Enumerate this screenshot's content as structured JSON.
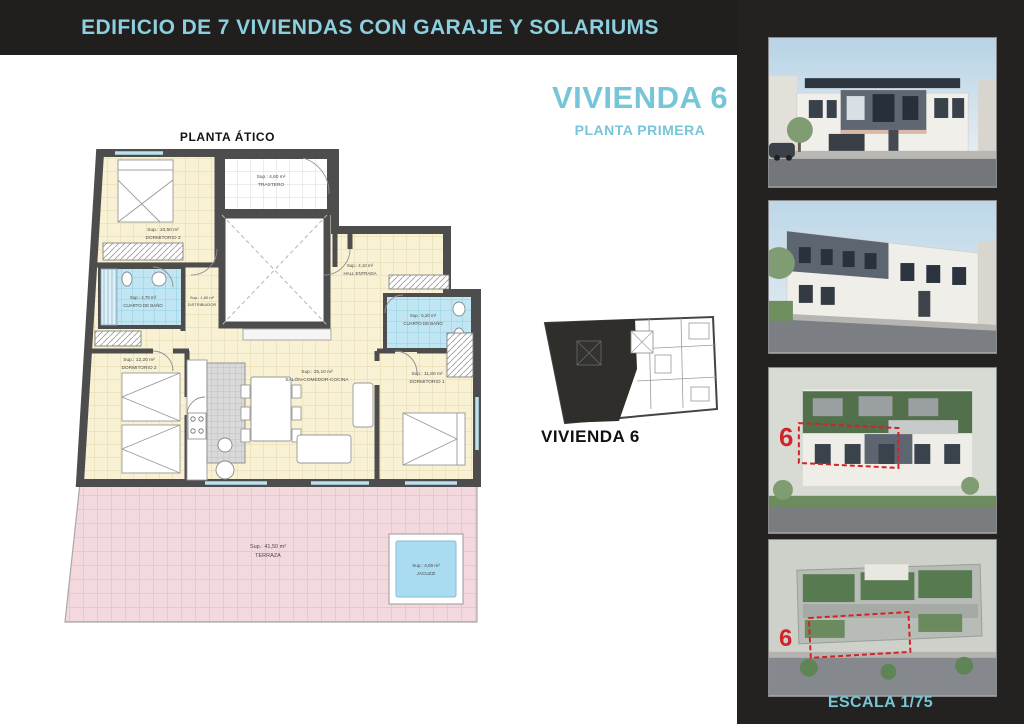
{
  "header": {
    "title": "EDIFICIO DE 7 VIVIENDAS CON GARAJE Y SOLARIUMS"
  },
  "unit": {
    "title": "VIVIENDA 6",
    "subtitle": "PLANTA PRIMERA"
  },
  "plan": {
    "title": "PLANTA ÁTICO",
    "rooms": {
      "trastero": {
        "area": "Sup.: 4,60 m²",
        "name": "TRASTERO"
      },
      "dormitorio3": {
        "area": "Sup.: 10,50 m²",
        "name": "DORMITORIO 3"
      },
      "bano_izq": {
        "area": "Sup.: 4,70 m²",
        "name": "CUARTO DE BAÑO"
      },
      "distribuidor": {
        "area": "Sup.: 1,80 m²",
        "name": "DISTRIBUIDOR"
      },
      "hall": {
        "area": "Sup.: 4,10 m²",
        "name": "HALL ENTRADA"
      },
      "bano_der": {
        "area": "Sup.: 5,20 m²",
        "name": "CUARTO DE BAÑO"
      },
      "dormitorio2": {
        "area": "Sup.: 12,20 m²",
        "name": "DORMITORIO 2"
      },
      "salon": {
        "area": "Sup.: 25,10 m²",
        "name": "SALÓN-COMEDOR-COCINA"
      },
      "dormitorio1": {
        "area": "Sup.: 11,80 m²",
        "name": "DORMITORIO 1"
      },
      "terraza": {
        "area": "Sup.: 41,50 m²",
        "name": "TERRAZA"
      },
      "jacuzzi": {
        "area": "Sup.: 4,00 m²",
        "name": "JACUZZI"
      }
    }
  },
  "key_plan": {
    "label": "VIVIENDA 6"
  },
  "sidebar": {
    "marker_unit": "6",
    "scale": "ESCALA 1/75"
  },
  "colors": {
    "accent": "#76c5d9",
    "marker_red": "#d2232a",
    "wall": "#4d4d4d"
  }
}
